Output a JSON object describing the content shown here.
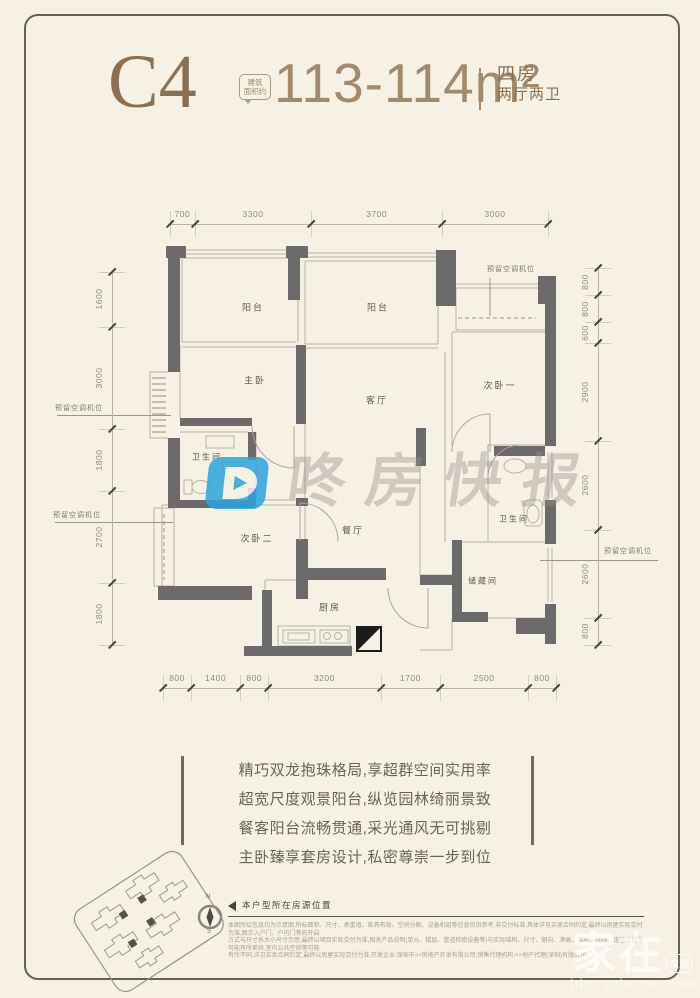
{
  "header": {
    "unit_code": "C4",
    "area_badge": {
      "line1": "建筑",
      "line2": "面积约"
    },
    "area": "113-114m²",
    "layout": {
      "line1": "四房",
      "line2": "两厅两卫"
    }
  },
  "floorplan": {
    "rooms": [
      "阳台",
      "阳台",
      "主卧",
      "客厅",
      "次卧一",
      "卫生间",
      "次卧二",
      "餐厅",
      "厨房",
      "卫生间",
      "储藏间"
    ],
    "ac_reserved_label": "预留空调机位",
    "dimensions": {
      "top": [
        "700",
        "3300",
        "3700",
        "3000"
      ],
      "bottom": [
        "800",
        "1400",
        "800",
        "3200",
        "1700",
        "2500",
        "800"
      ],
      "left": [
        "1600",
        "3000",
        "1800",
        "2700",
        "1800"
      ],
      "right": [
        "800",
        "800",
        "600",
        "2900",
        "2600",
        "2600",
        "800"
      ]
    },
    "compass": {
      "north": "N",
      "south": "S"
    }
  },
  "watermark": {
    "text": "咚房快报"
  },
  "description": {
    "lines": [
      "精巧双龙抱珠格局,享超群空间实用率",
      "超宽尺度观景阳台,纵览园林绮丽景致",
      "餐客阳台流畅贯通,采光通风无可挑剔",
      "主卧臻享套房设计,私密尊崇一步到位"
    ]
  },
  "legend": {
    "label": "本户型所在房源位置"
  },
  "disclaimer": {
    "lines": [
      "本图所绘信息均为示意图,所标面积、尺寸、承重墙、家具布局、空间分割、设备机组等信息仅供参考,非交付标准,具体详见买卖合同约定,最终以房屋实际交付为准,图示入户门、户内门等的开启",
      "方式与尺寸系大小尺寸示意,最终以项目实际交付为准,相关产品说明(单元、楼层、管道检修设备等)与实际结构、尺寸、朝向、净高、面积、视线、走管位置等可能有所差异,室内公共空间等可能",
      "有所不同,详见买卖合同约定,最终以房屋实际交付为准,开发企业:深圳市××房地产开发有限公司,销售代理机构:××地产代理(深圳)有限公司。"
    ]
  },
  "corner_watermark": {
    "main": "家在",
    "bubble": "深圳",
    "url": "bbs.szhome.com"
  },
  "colors": {
    "page_bg": "#f6f1e5",
    "frame_border": "#6b5f4e",
    "title_brown": "#8a7052",
    "area_tan": "#a28a6c",
    "wall_gray": "#6b6b6b",
    "watermark_blue": "#2ba4de"
  }
}
